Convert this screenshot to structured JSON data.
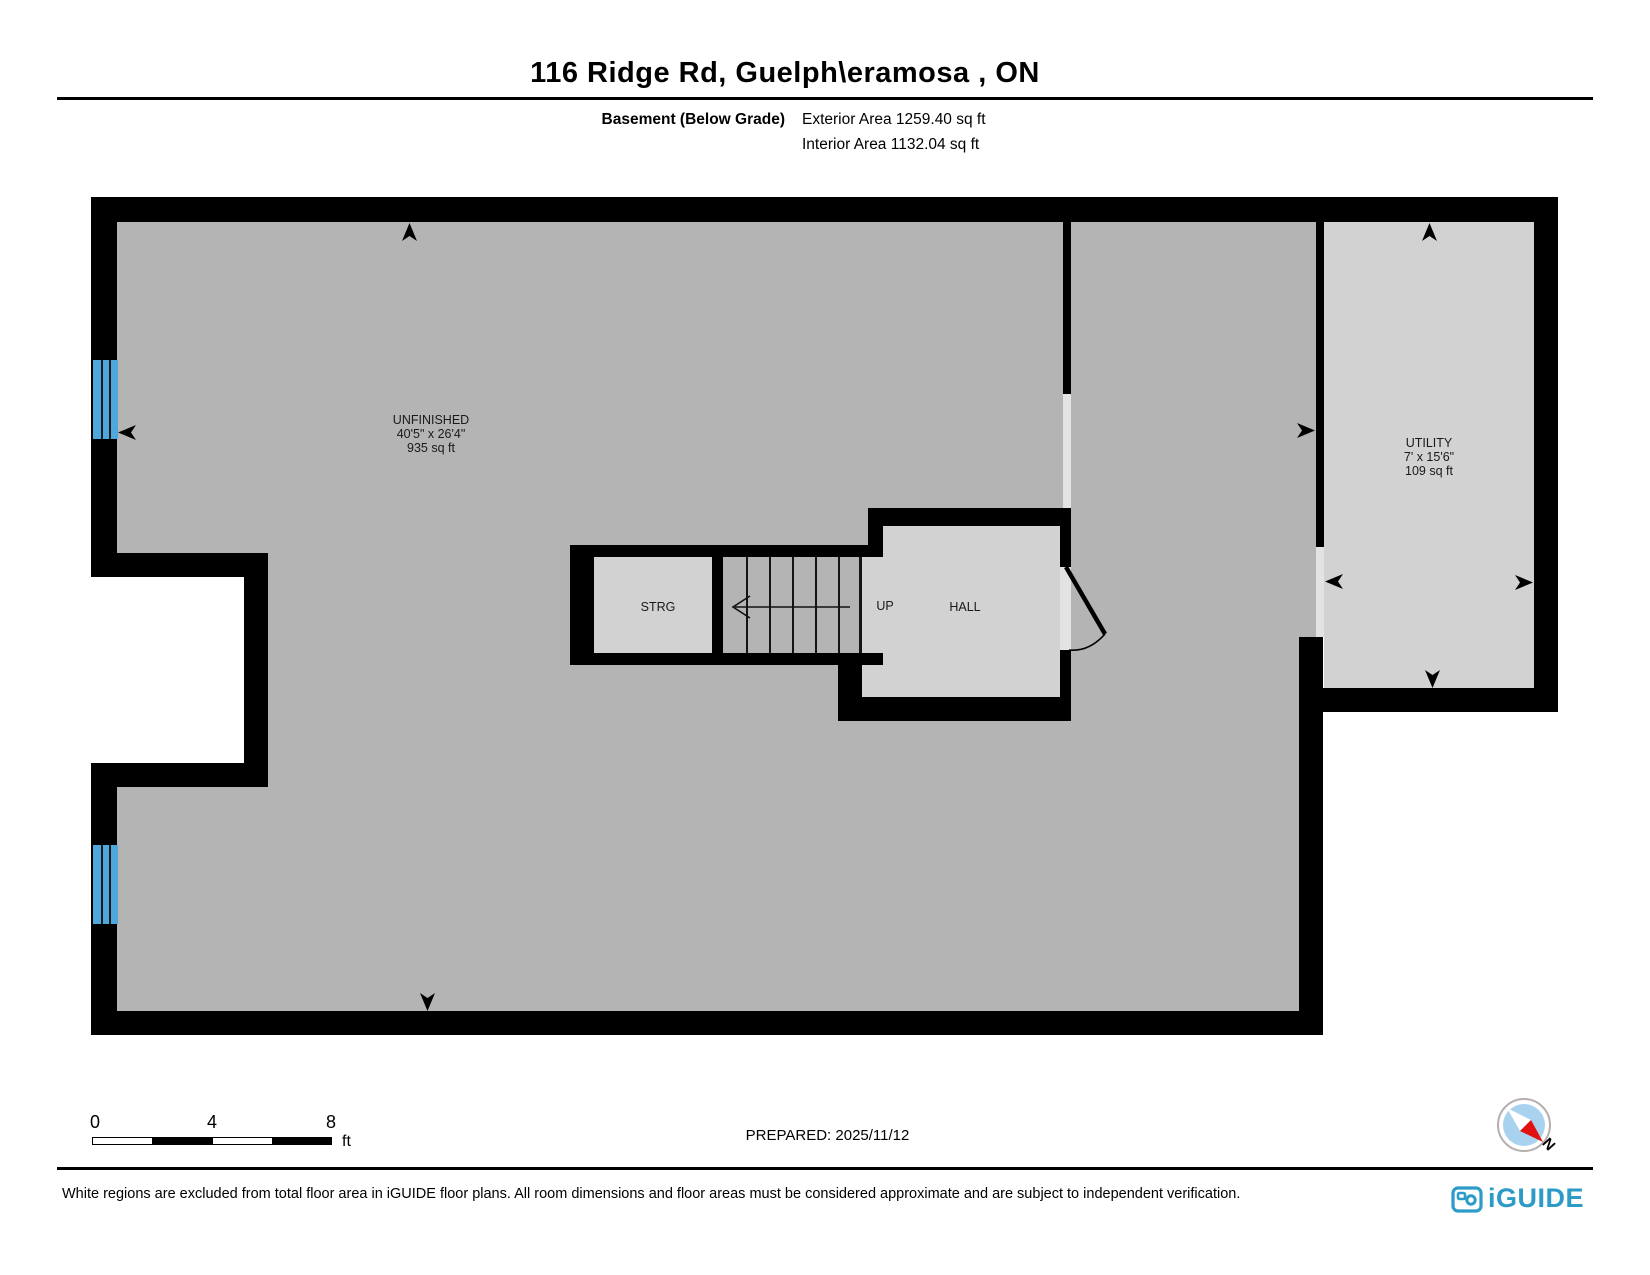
{
  "header": {
    "title": "116 Ridge Rd, Guelph\\eramosa , ON",
    "floor_label": "Basement (Below Grade)",
    "exterior_area": "Exterior Area 1259.40 sq ft",
    "interior_area": "Interior Area 1132.04 sq ft"
  },
  "plan": {
    "rooms": {
      "unfinished": {
        "name": "UNFINISHED",
        "dims": "40'5\" x 26'4\"",
        "area": "935 sq ft"
      },
      "utility": {
        "name": "UTILITY",
        "dims": "7' x 15'6\"",
        "area": "109 sq ft"
      },
      "strg": {
        "name": "STRG"
      },
      "up": {
        "name": "UP"
      },
      "hall": {
        "name": "HALL"
      }
    },
    "colors": {
      "wall": "#000000",
      "floor_gray": "#b4b4b4",
      "room_gray": "#d2d2d2",
      "opening_gray": "#e3e3e3",
      "window_blue": "#4fa8dc"
    }
  },
  "scale_bar": {
    "tick0": "0",
    "tick4": "4",
    "tick8": "8",
    "unit": "ft"
  },
  "prepared": "PREPARED: 2025/11/12",
  "compass": {
    "north_label": "N",
    "needle_red": "#e01111",
    "dial_blue": "#a9d2ef"
  },
  "footer": {
    "disclaimer": "White regions are excluded from total floor area in iGUIDE floor plans. All room dimensions and floor areas must be considered approximate and are subject to independent verification.",
    "logo_text": "iGUIDE",
    "brand_color": "#2d9bc7"
  }
}
